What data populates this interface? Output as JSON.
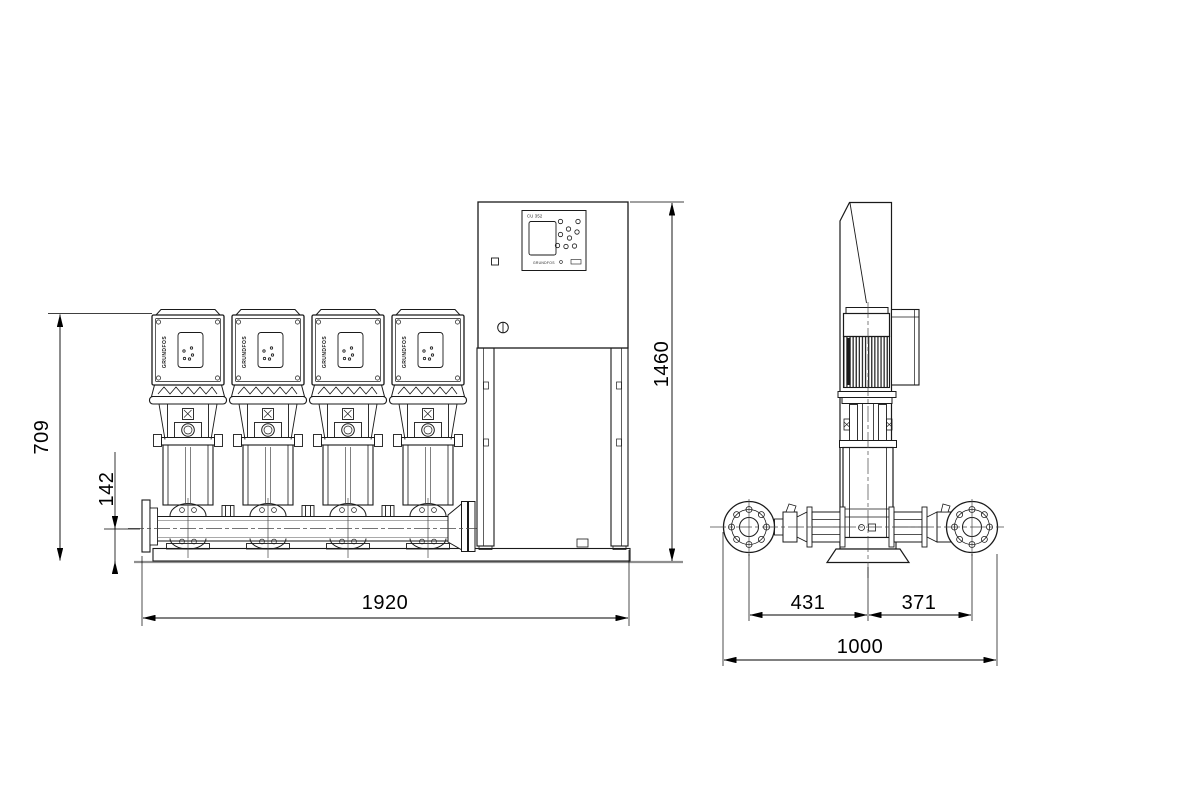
{
  "brand": {
    "name": "GRUNDFOS",
    "control_unit_label": "CU 352"
  },
  "front_view": {
    "pump_count": 4,
    "dimensions": {
      "pump_height": "709",
      "manifold_center_height": "142",
      "total_length": "1920",
      "total_height": "1460"
    }
  },
  "side_view": {
    "dimensions": {
      "suction_offset": "431",
      "discharge_offset": "371",
      "total_depth": "1000"
    }
  },
  "colors": {
    "line": "#1a1a1a",
    "thin_line": "#3a3a3a",
    "centerline": "#474747",
    "floor": "#8f8f8f",
    "background": "#ffffff"
  }
}
